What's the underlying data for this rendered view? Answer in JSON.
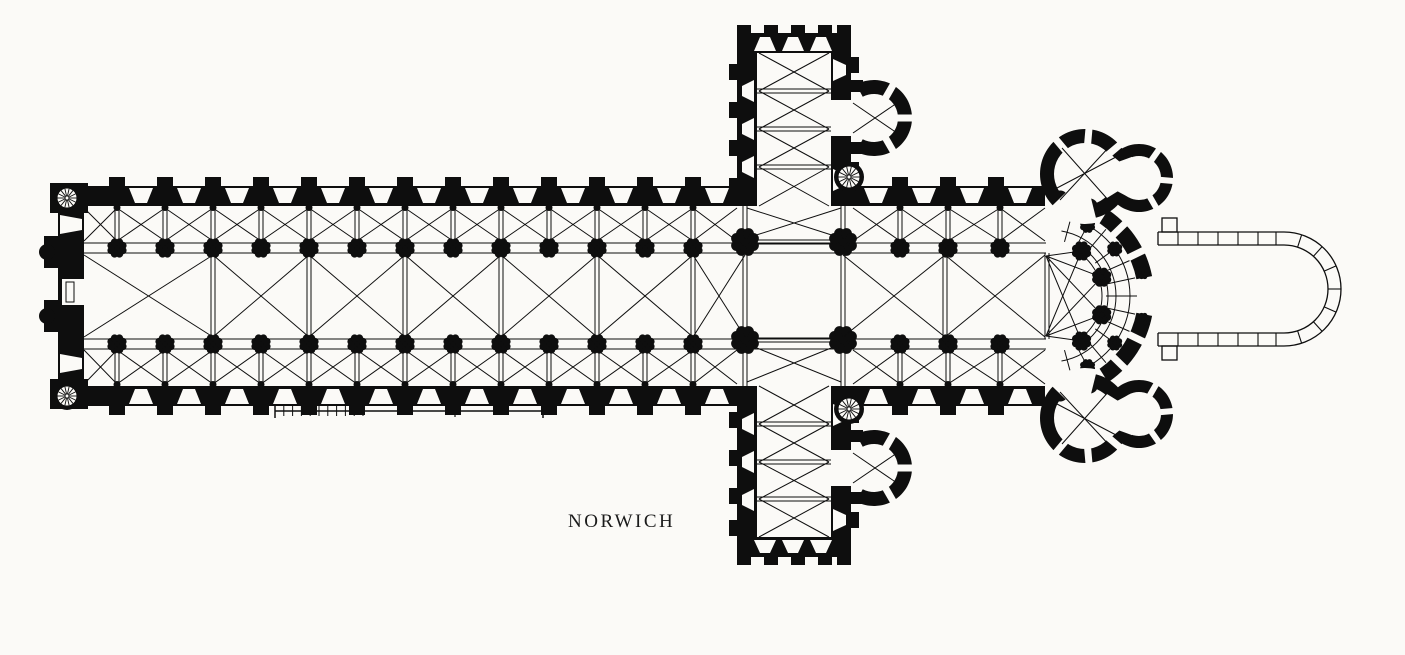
{
  "figure": {
    "label": "NORWICH",
    "ink": "#0e0e0e",
    "paper": "#fbfaf7"
  }
}
